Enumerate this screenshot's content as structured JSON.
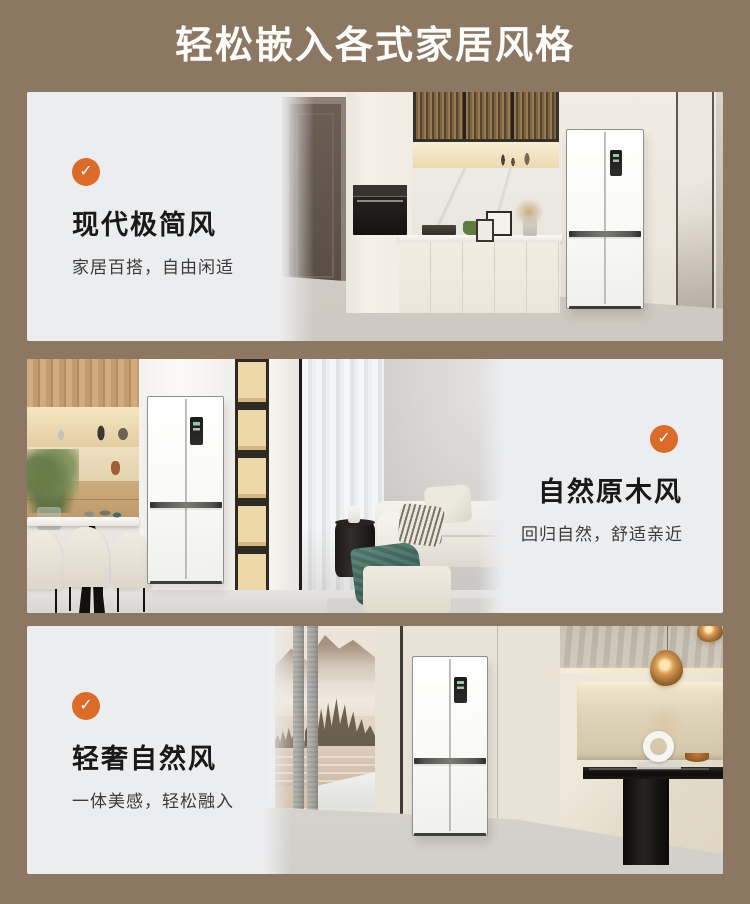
{
  "page": {
    "background": "#8c7862",
    "panel_background": "#ecedef",
    "title": "轻松嵌入各式家居风格"
  },
  "badge": {
    "color": "#dc6b2a",
    "check": "✓"
  },
  "panels": [
    {
      "heading": "现代极简风",
      "subtitle": "家居百搭，自由闲适",
      "text_side": "left",
      "scene": "modern-minimal-kitchen-with-fridge"
    },
    {
      "heading": "自然原木风",
      "subtitle": "回归自然，舒适亲近",
      "text_side": "right",
      "scene": "natural-wood-dining-living-with-fridge"
    },
    {
      "heading": "轻奢自然风",
      "subtitle": "一体美感，轻松融入",
      "text_side": "left",
      "scene": "light-luxury-dining-with-fridge"
    }
  ]
}
